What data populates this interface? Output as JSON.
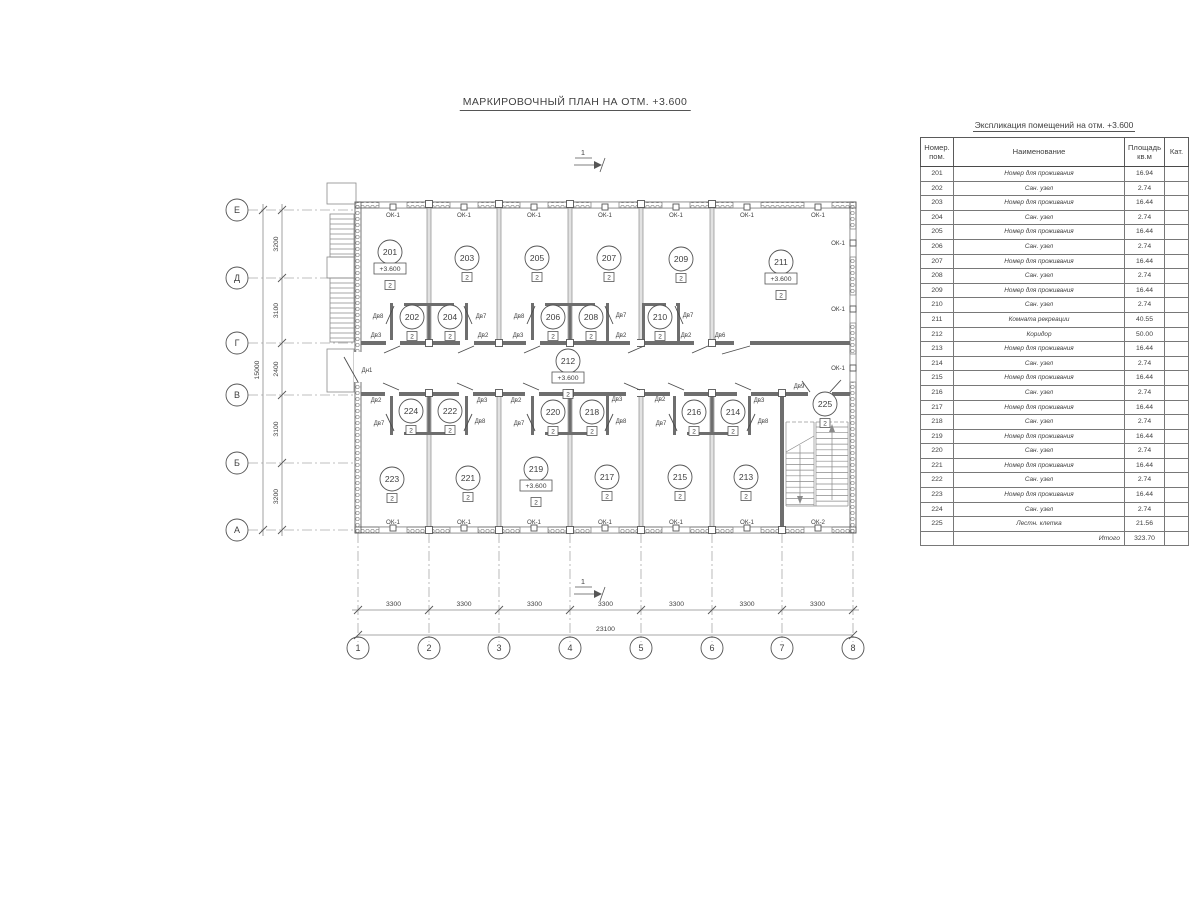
{
  "page": {
    "title": "МАРКИРОВОЧНЫЙ ПЛАН НА ОТМ. +3.600"
  },
  "plan": {
    "section_mark": "1",
    "category_mark": "2",
    "level_mark": "+3.600",
    "axes": {
      "rows": [
        {
          "label": "Е",
          "y": 210
        },
        {
          "label": "Д",
          "y": 278
        },
        {
          "label": "Г",
          "y": 343
        },
        {
          "label": "В",
          "y": 395
        },
        {
          "label": "Б",
          "y": 463
        },
        {
          "label": "А",
          "y": 530
        }
      ],
      "cols": [
        {
          "label": "1",
          "x": 358
        },
        {
          "label": "2",
          "x": 429
        },
        {
          "label": "3",
          "x": 499
        },
        {
          "label": "4",
          "x": 570
        },
        {
          "label": "5",
          "x": 641
        },
        {
          "label": "6",
          "x": 712
        },
        {
          "label": "7",
          "x": 782
        },
        {
          "label": "8",
          "x": 853
        }
      ]
    },
    "dims": {
      "row_segments": [
        "3200",
        "3100",
        "2400",
        "3100",
        "3200"
      ],
      "row_total": "15000",
      "col_segments": [
        "3300",
        "3300",
        "3300",
        "3300",
        "3300",
        "3300",
        "3300"
      ],
      "col_total": "23100"
    },
    "rooms": [
      {
        "number": "201",
        "x": 390,
        "y": 252,
        "lvl": true
      },
      {
        "number": "202",
        "x": 412,
        "y": 317
      },
      {
        "number": "203",
        "x": 467,
        "y": 258
      },
      {
        "number": "204",
        "x": 450,
        "y": 317
      },
      {
        "number": "205",
        "x": 537,
        "y": 258
      },
      {
        "number": "206",
        "x": 553,
        "y": 317
      },
      {
        "number": "207",
        "x": 609,
        "y": 258
      },
      {
        "number": "208",
        "x": 591,
        "y": 317
      },
      {
        "number": "209",
        "x": 681,
        "y": 259
      },
      {
        "number": "210",
        "x": 660,
        "y": 317
      },
      {
        "number": "211",
        "x": 781,
        "y": 262,
        "lvl": true
      },
      {
        "number": "212",
        "x": 568,
        "y": 361,
        "lvl": true
      },
      {
        "number": "213",
        "x": 746,
        "y": 477
      },
      {
        "number": "214",
        "x": 733,
        "y": 412
      },
      {
        "number": "215",
        "x": 680,
        "y": 477
      },
      {
        "number": "216",
        "x": 694,
        "y": 412
      },
      {
        "number": "217",
        "x": 607,
        "y": 477
      },
      {
        "number": "218",
        "x": 592,
        "y": 412
      },
      {
        "number": "219",
        "x": 536,
        "y": 469,
        "lvl": true
      },
      {
        "number": "220",
        "x": 553,
        "y": 412
      },
      {
        "number": "221",
        "x": 468,
        "y": 478
      },
      {
        "number": "222",
        "x": 450,
        "y": 411
      },
      {
        "number": "223",
        "x": 392,
        "y": 479
      },
      {
        "number": "224",
        "x": 411,
        "y": 411
      },
      {
        "number": "225",
        "x": 825,
        "y": 404
      }
    ],
    "windows": [
      {
        "label": "ОК-1",
        "side": "top",
        "x": 393
      },
      {
        "label": "ОК-1",
        "side": "top",
        "x": 464
      },
      {
        "label": "ОК-1",
        "side": "top",
        "x": 534
      },
      {
        "label": "ОК-1",
        "side": "top",
        "x": 605
      },
      {
        "label": "ОК-1",
        "side": "top",
        "x": 676
      },
      {
        "label": "ОК-1",
        "side": "top",
        "x": 747
      },
      {
        "label": "ОК-1",
        "side": "top",
        "x": 818
      },
      {
        "label": "ОК-1",
        "side": "right",
        "y": 243
      },
      {
        "label": "ОК-1",
        "side": "right",
        "y": 309
      },
      {
        "label": "ОК-1",
        "side": "right",
        "y": 368
      },
      {
        "label": "ОК-1",
        "side": "bottom",
        "x": 393
      },
      {
        "label": "ОК-1",
        "side": "bottom",
        "x": 464
      },
      {
        "label": "ОК-1",
        "side": "bottom",
        "x": 534
      },
      {
        "label": "ОК-1",
        "side": "bottom",
        "x": 605
      },
      {
        "label": "ОК-1",
        "side": "bottom",
        "x": 676
      },
      {
        "label": "ОК-1",
        "side": "bottom",
        "x": 747
      },
      {
        "label": "ОК-2",
        "side": "bottom",
        "x": 818
      }
    ],
    "doors": [
      {
        "label": "Дв8",
        "lx": 378,
        "ly": 318,
        "gap": [
          393,
          302,
          11,
          5
        ],
        "leaf": [
          394,
          306,
          386,
          324
        ]
      },
      {
        "label": "Дв7",
        "lx": 481,
        "ly": 318,
        "gap": [
          454,
          302,
          11,
          5
        ],
        "leaf": [
          464,
          306,
          472,
          324
        ]
      },
      {
        "label": "Дв8",
        "lx": 519,
        "ly": 318,
        "gap": [
          534,
          302,
          11,
          5
        ],
        "leaf": [
          535,
          306,
          527,
          324
        ]
      },
      {
        "label": "Дв7",
        "lx": 621,
        "ly": 317,
        "gap": [
          595,
          302,
          11,
          5
        ],
        "leaf": [
          605,
          306,
          613,
          324
        ]
      },
      {
        "label": "Дв7",
        "lx": 688,
        "ly": 317,
        "gap": [
          666,
          302,
          10,
          5
        ],
        "leaf": [
          675,
          306,
          683,
          324
        ]
      },
      {
        "label": "Дв3",
        "lx": 376,
        "ly": 337,
        "gap": [
          386,
          340,
          14,
          6
        ],
        "leaf": [
          400,
          346,
          384,
          353
        ]
      },
      {
        "label": "Дв2",
        "lx": 483,
        "ly": 337,
        "gap": [
          460,
          340,
          14,
          6
        ],
        "leaf": [
          474,
          346,
          458,
          353
        ]
      },
      {
        "label": "Дв3",
        "lx": 518,
        "ly": 337,
        "gap": [
          526,
          340,
          14,
          6
        ],
        "leaf": [
          540,
          346,
          524,
          353
        ]
      },
      {
        "label": "Дв2",
        "lx": 621,
        "ly": 337,
        "gap": [
          630,
          340,
          14,
          6
        ],
        "leaf": [
          644,
          346,
          628,
          353
        ]
      },
      {
        "label": "Дв2",
        "lx": 686,
        "ly": 337,
        "gap": [
          694,
          340,
          14,
          6
        ],
        "leaf": [
          708,
          346,
          692,
          353
        ]
      },
      {
        "label": "Дв6",
        "lx": 720,
        "ly": 337,
        "gap": [
          734,
          340,
          16,
          6
        ],
        "leaf": [
          750,
          346,
          722,
          354
        ]
      },
      {
        "label": "Дв2",
        "lx": 376,
        "ly": 402,
        "gap": [
          385,
          390,
          14,
          6
        ],
        "leaf": [
          399,
          390,
          383,
          383
        ]
      },
      {
        "label": "Дв3",
        "lx": 482,
        "ly": 402,
        "gap": [
          459,
          390,
          14,
          6
        ],
        "leaf": [
          473,
          390,
          457,
          383
        ]
      },
      {
        "label": "Дв2",
        "lx": 516,
        "ly": 402,
        "gap": [
          525,
          390,
          14,
          6
        ],
        "leaf": [
          539,
          390,
          523,
          383
        ]
      },
      {
        "label": "Дв3",
        "lx": 617,
        "ly": 401,
        "gap": [
          626,
          390,
          14,
          6
        ],
        "leaf": [
          640,
          390,
          624,
          383
        ]
      },
      {
        "label": "Дв2",
        "lx": 660,
        "ly": 401,
        "gap": [
          670,
          390,
          14,
          6
        ],
        "leaf": [
          684,
          390,
          668,
          383
        ]
      },
      {
        "label": "Дв3",
        "lx": 759,
        "ly": 402,
        "gap": [
          737,
          390,
          14,
          6
        ],
        "leaf": [
          751,
          390,
          735,
          383
        ]
      },
      {
        "label": "Дв9",
        "lx": 799,
        "ly": 388,
        "gap": [
          808,
          390,
          24,
          6
        ],
        "leaf": [
          810,
          392,
          802,
          381
        ],
        "leaf2": [
          830,
          392,
          841,
          380
        ]
      },
      {
        "label": "Дв7",
        "lx": 379,
        "ly": 425,
        "gap": [
          393,
          431,
          11,
          5
        ],
        "leaf": [
          394,
          431,
          386,
          414
        ]
      },
      {
        "label": "Дв8",
        "lx": 480,
        "ly": 423,
        "gap": [
          454,
          431,
          11,
          5
        ],
        "leaf": [
          464,
          431,
          472,
          414
        ]
      },
      {
        "label": "Дв7",
        "lx": 519,
        "ly": 425,
        "gap": [
          534,
          431,
          11,
          5
        ],
        "leaf": [
          535,
          431,
          527,
          414
        ]
      },
      {
        "label": "Дв8",
        "lx": 621,
        "ly": 423,
        "gap": [
          595,
          431,
          11,
          5
        ],
        "leaf": [
          605,
          431,
          613,
          414
        ]
      },
      {
        "label": "Дв7",
        "lx": 661,
        "ly": 425,
        "gap": [
          676,
          431,
          11,
          5
        ],
        "leaf": [
          677,
          431,
          669,
          414
        ]
      },
      {
        "label": "Дв8",
        "lx": 763,
        "ly": 423,
        "gap": [
          737,
          431,
          11,
          5
        ],
        "leaf": [
          747,
          431,
          755,
          414
        ]
      },
      {
        "label": "Дн1",
        "lx": 367,
        "ly": 372,
        "gap": [
          354,
          352,
          8,
          30
        ],
        "leaf": [
          358,
          382,
          344,
          357
        ]
      }
    ]
  },
  "table": {
    "title": "Экспликация помещений на отм. +3.600",
    "headers": [
      "Номер.\nпом.",
      "Наименование",
      "Площадь\nкв.м",
      "Кат."
    ],
    "rows": [
      {
        "n": "201",
        "name": "Номер для проживания",
        "area": "16.94",
        "cat": ""
      },
      {
        "n": "202",
        "name": "Сан. узел",
        "area": "2.74",
        "cat": ""
      },
      {
        "n": "203",
        "name": "Номер для проживания",
        "area": "16.44",
        "cat": ""
      },
      {
        "n": "204",
        "name": "Сан. узел",
        "area": "2.74",
        "cat": ""
      },
      {
        "n": "205",
        "name": "Номер для проживания",
        "area": "16.44",
        "cat": ""
      },
      {
        "n": "206",
        "name": "Сан. узел",
        "area": "2.74",
        "cat": ""
      },
      {
        "n": "207",
        "name": "Номер для проживания",
        "area": "16.44",
        "cat": ""
      },
      {
        "n": "208",
        "name": "Сан. узел",
        "area": "2.74",
        "cat": ""
      },
      {
        "n": "209",
        "name": "Номер для проживания",
        "area": "16.44",
        "cat": ""
      },
      {
        "n": "210",
        "name": "Сан. узел",
        "area": "2.74",
        "cat": ""
      },
      {
        "n": "211",
        "name": "Комната рекреации",
        "area": "40.55",
        "cat": ""
      },
      {
        "n": "212",
        "name": "Коридор",
        "area": "50.00",
        "cat": ""
      },
      {
        "n": "213",
        "name": "Номер для проживания",
        "area": "16.44",
        "cat": ""
      },
      {
        "n": "214",
        "name": "Сан. узел",
        "area": "2.74",
        "cat": ""
      },
      {
        "n": "215",
        "name": "Номер для проживания",
        "area": "16.44",
        "cat": ""
      },
      {
        "n": "216",
        "name": "Сан. узел",
        "area": "2.74",
        "cat": ""
      },
      {
        "n": "217",
        "name": "Номер для проживания",
        "area": "16.44",
        "cat": ""
      },
      {
        "n": "218",
        "name": "Сан. узел",
        "area": "2.74",
        "cat": ""
      },
      {
        "n": "219",
        "name": "Номер для проживания",
        "area": "16.44",
        "cat": ""
      },
      {
        "n": "220",
        "name": "Сан. узел",
        "area": "2.74",
        "cat": ""
      },
      {
        "n": "221",
        "name": "Номер для проживания",
        "area": "16.44",
        "cat": ""
      },
      {
        "n": "222",
        "name": "Сан. узел",
        "area": "2.74",
        "cat": ""
      },
      {
        "n": "223",
        "name": "Номер для проживания",
        "area": "16.44",
        "cat": ""
      },
      {
        "n": "224",
        "name": "Сан. узел",
        "area": "2.74",
        "cat": ""
      },
      {
        "n": "225",
        "name": "Лестн. клетка",
        "area": "21.56",
        "cat": ""
      }
    ],
    "total": {
      "label": "Итого",
      "area": "323.70"
    }
  }
}
